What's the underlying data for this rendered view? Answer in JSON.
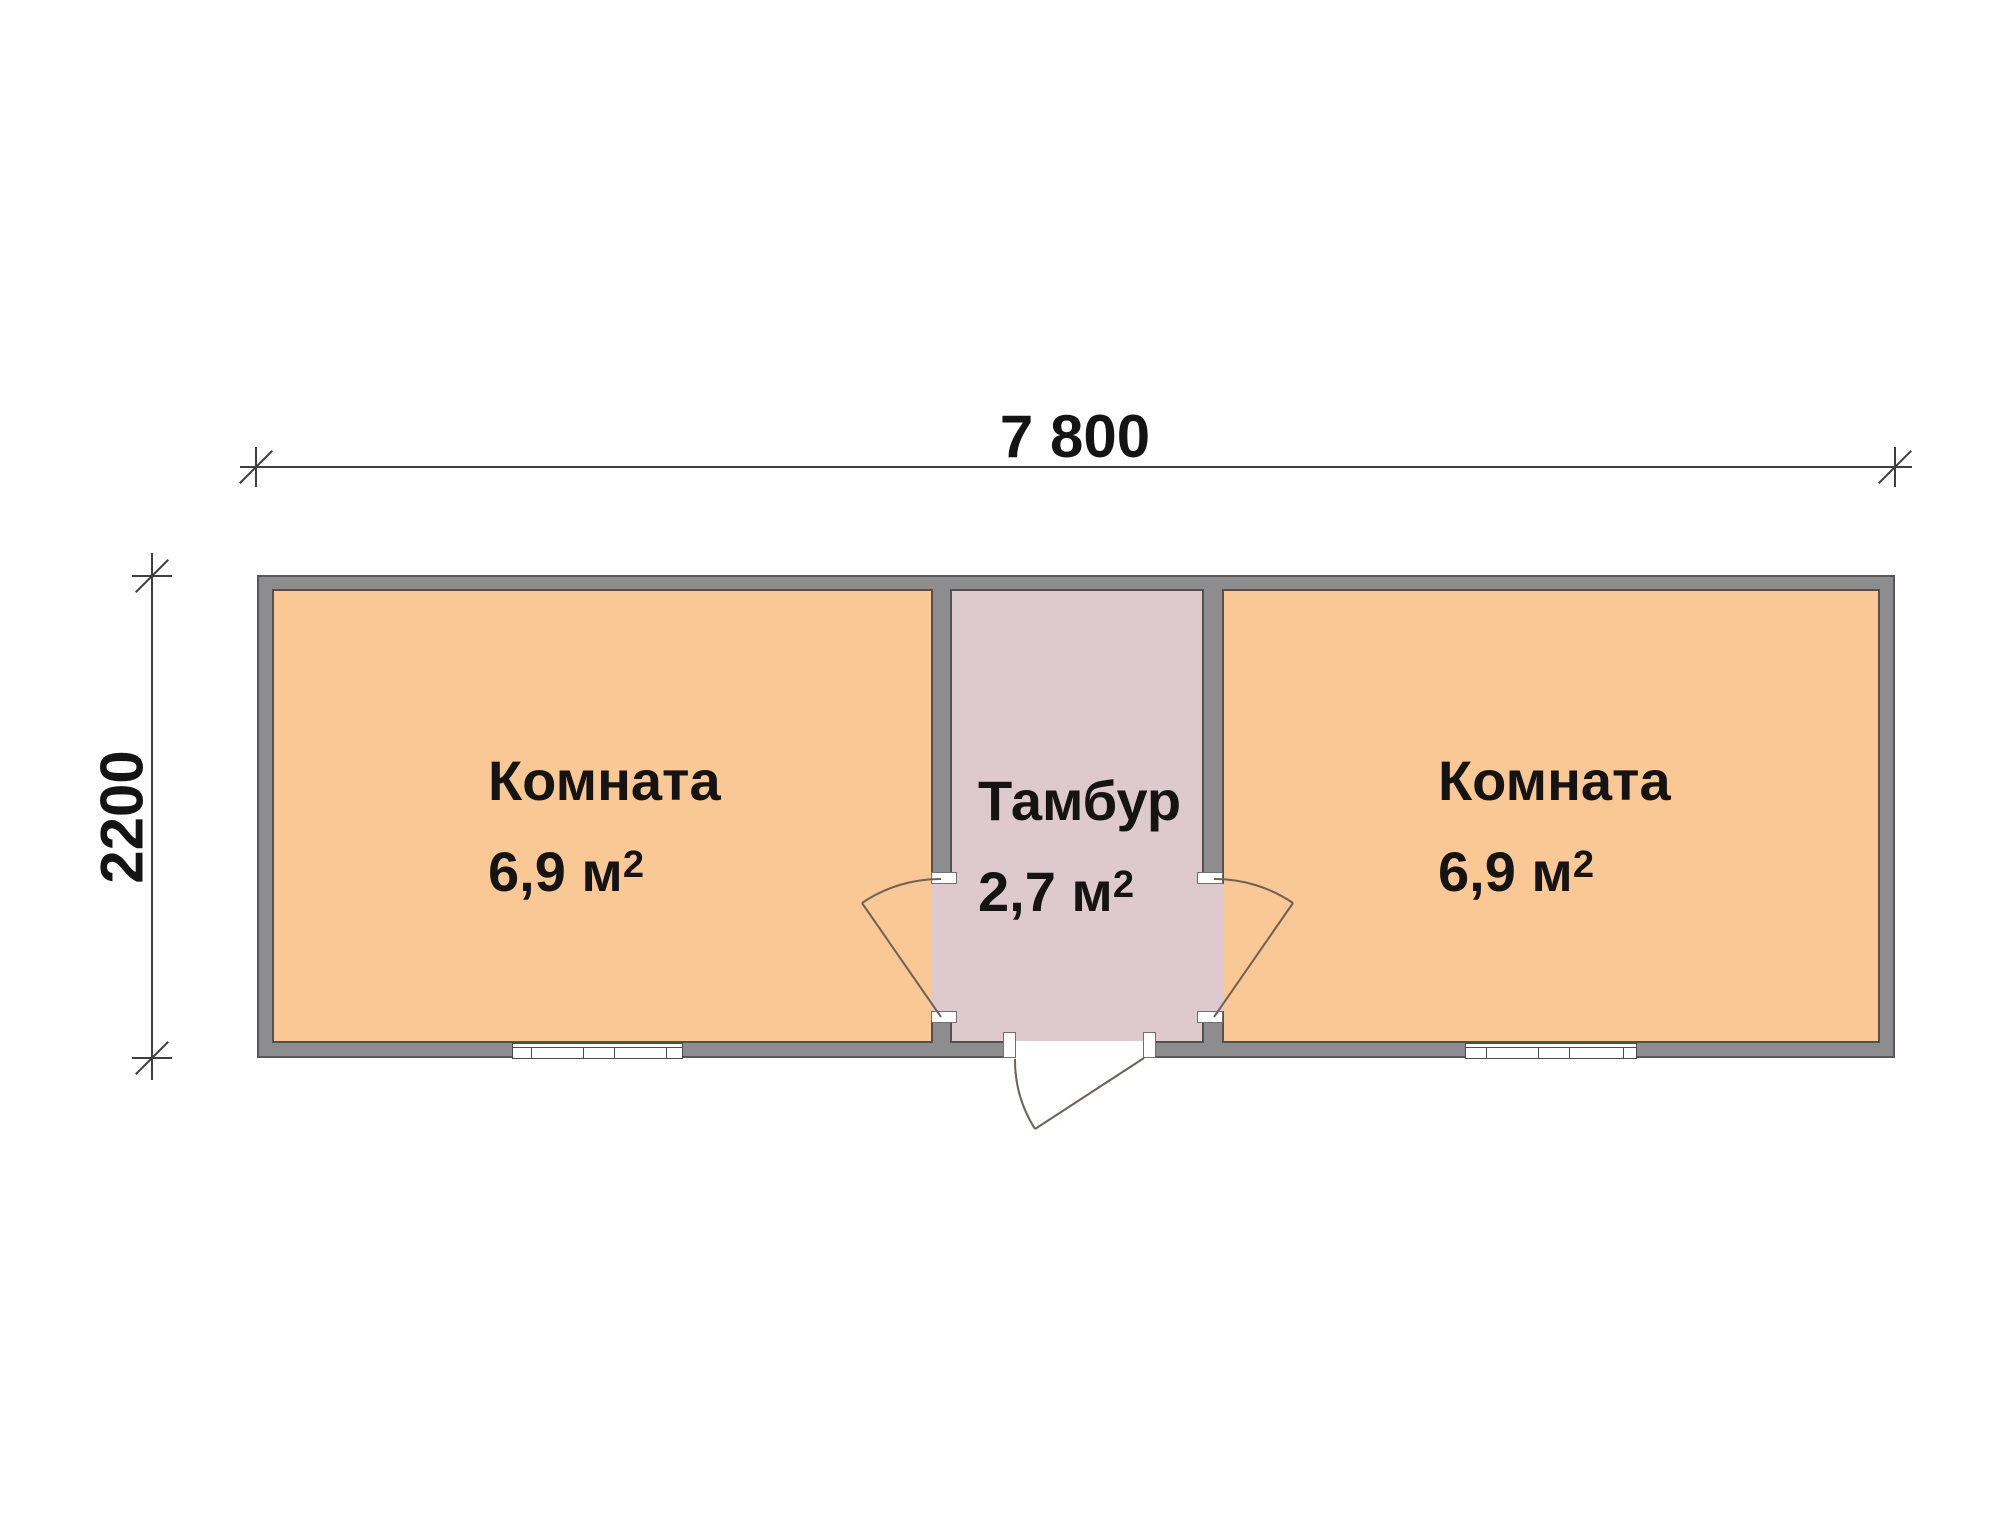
{
  "dimension_labels": {
    "overall_width_mm": "7 800",
    "overall_depth_mm": "2200"
  },
  "rooms": {
    "left_room": {
      "name": "Комната",
      "area": "6,9 м",
      "area_superscript": "2"
    },
    "vestibule": {
      "name": "Тамбур",
      "area": "2,7 м",
      "area_superscript": "2"
    },
    "right_room": {
      "name": "Комната",
      "area": "6,9 м",
      "area_superscript": "2"
    }
  },
  "colors": {
    "room_fill": "#f9c894",
    "vestibule_fill": "#decace",
    "wall_fill": "#8d8d8f",
    "wall_outline": "#58585a",
    "floor_outline": "#54504a",
    "dimension_line": "#3f3f41",
    "door_line": "#6e6155",
    "window_frame": "#4a4a4c",
    "text": "#141414",
    "background": "#ffffff"
  }
}
